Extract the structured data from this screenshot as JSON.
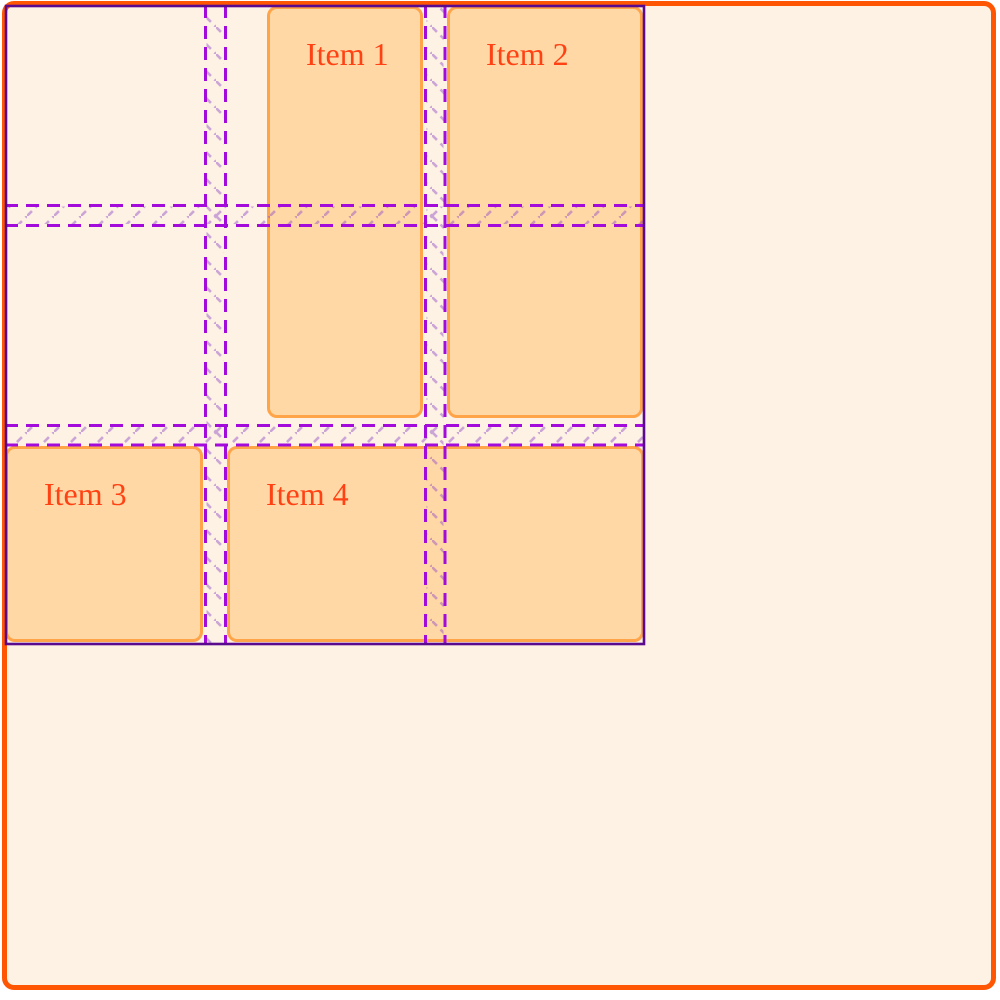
{
  "items": [
    {
      "label": "Item 1"
    },
    {
      "label": "Item 2"
    },
    {
      "label": "Item 3"
    },
    {
      "label": "Item 4"
    }
  ],
  "colors": {
    "page_bg": "#ffffff",
    "container_bg": "#fdf2e4",
    "container_border": "#ff5603",
    "item_bg": "#ffd8a6",
    "item_border": "#ffa448",
    "item_text": "#ff4113",
    "grid_outline": "#5a0a8c",
    "grid_line": "#a30bdb",
    "gap_hatch": "#8f46c8"
  }
}
